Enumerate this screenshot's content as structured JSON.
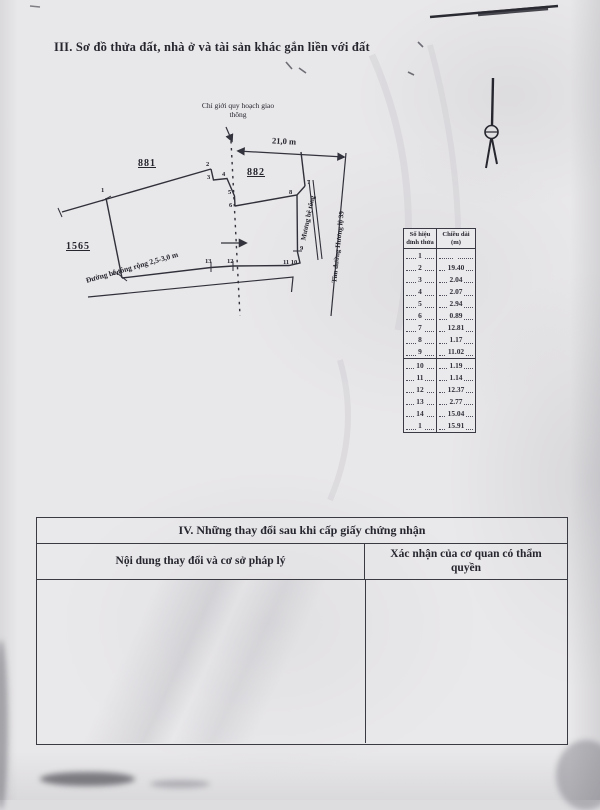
{
  "section3": {
    "title": "III. Sơ đồ thửa đất, nhà ở và tài sản khác gắn liền với đất"
  },
  "diagram": {
    "planning_boundary_label": "Chỉ giới quy hoạch giao thông",
    "dimension_label": "21,0 m",
    "parcel_881": "881",
    "parcel_882": "882",
    "parcel_1565": "1565",
    "ditch_label": "Mương bê tông",
    "road_axis_label": "Tim đường Hương lộ 39",
    "road_label": "Đường bê tông rộng 2,5-3,0 m",
    "points": {
      "p1": "1",
      "p2": "2",
      "p3": "3",
      "p4": "4",
      "p5": "5",
      "p6": "6",
      "p7": "7",
      "p8": "8",
      "p9": "9",
      "p10_11": "11 10",
      "p12": "12",
      "p13": "13",
      "p14": "14"
    }
  },
  "vertex_table": {
    "col1_header": "Số hiệu đỉnh thửa",
    "col2_header": "Chiều dài (m)",
    "rows": [
      {
        "v": "1",
        "len": ""
      },
      {
        "v": "2",
        "len": "19.40"
      },
      {
        "v": "3",
        "len": "2.04"
      },
      {
        "v": "4",
        "len": "2.07"
      },
      {
        "v": "5",
        "len": "2.94"
      },
      {
        "v": "6",
        "len": "0.89"
      },
      {
        "v": "7",
        "len": "12.81"
      },
      {
        "v": "8",
        "len": "1.17"
      },
      {
        "v": "9",
        "len": "11.02"
      },
      {
        "v": "10",
        "len": "1.19"
      },
      {
        "v": "11",
        "len": "1.14"
      },
      {
        "v": "12",
        "len": "12.37"
      },
      {
        "v": "13",
        "len": "2.77"
      },
      {
        "v": "14",
        "len": "15.04"
      },
      {
        "v": "1",
        "len": "15.91"
      }
    ]
  },
  "section4": {
    "title": "IV. Những thay đổi sau khi cấp giấy chứng nhận",
    "col1_header": "Nội dung thay đổi và cơ sở pháp lý",
    "col2_header": "Xác nhận của cơ quan có thẩm quyền"
  },
  "colors": {
    "paper": "#e8e7e9",
    "ink": "#26262f",
    "line": "#33333d"
  }
}
